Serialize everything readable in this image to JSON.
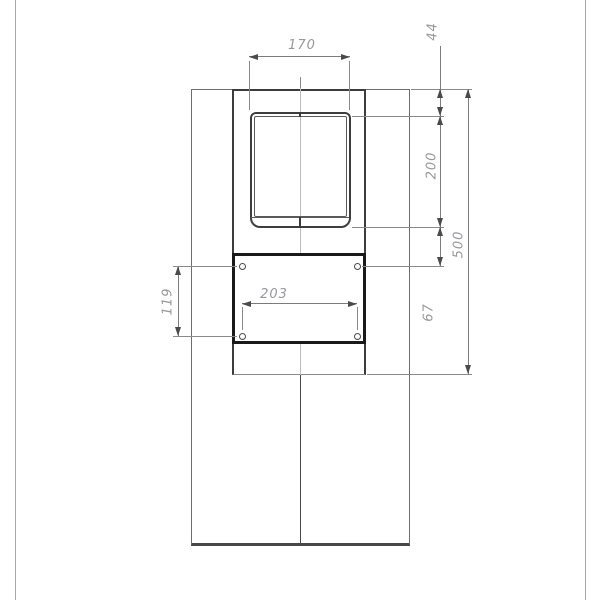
{
  "drawing": {
    "dimensions": {
      "window_width": "170",
      "top_to_window": "44",
      "window_height": "200",
      "overall_height": "500",
      "window_to_holes": "67",
      "hole_spacing_horizontal": "203",
      "hole_spacing_vertical": "119"
    },
    "colors": {
      "outline": "#6e6e6e",
      "thick_outline": "#1a1a1a",
      "dimension_line": "#7c7c7c",
      "dimension_text": "#98989c",
      "centerline": "#bcbcbc"
    }
  }
}
